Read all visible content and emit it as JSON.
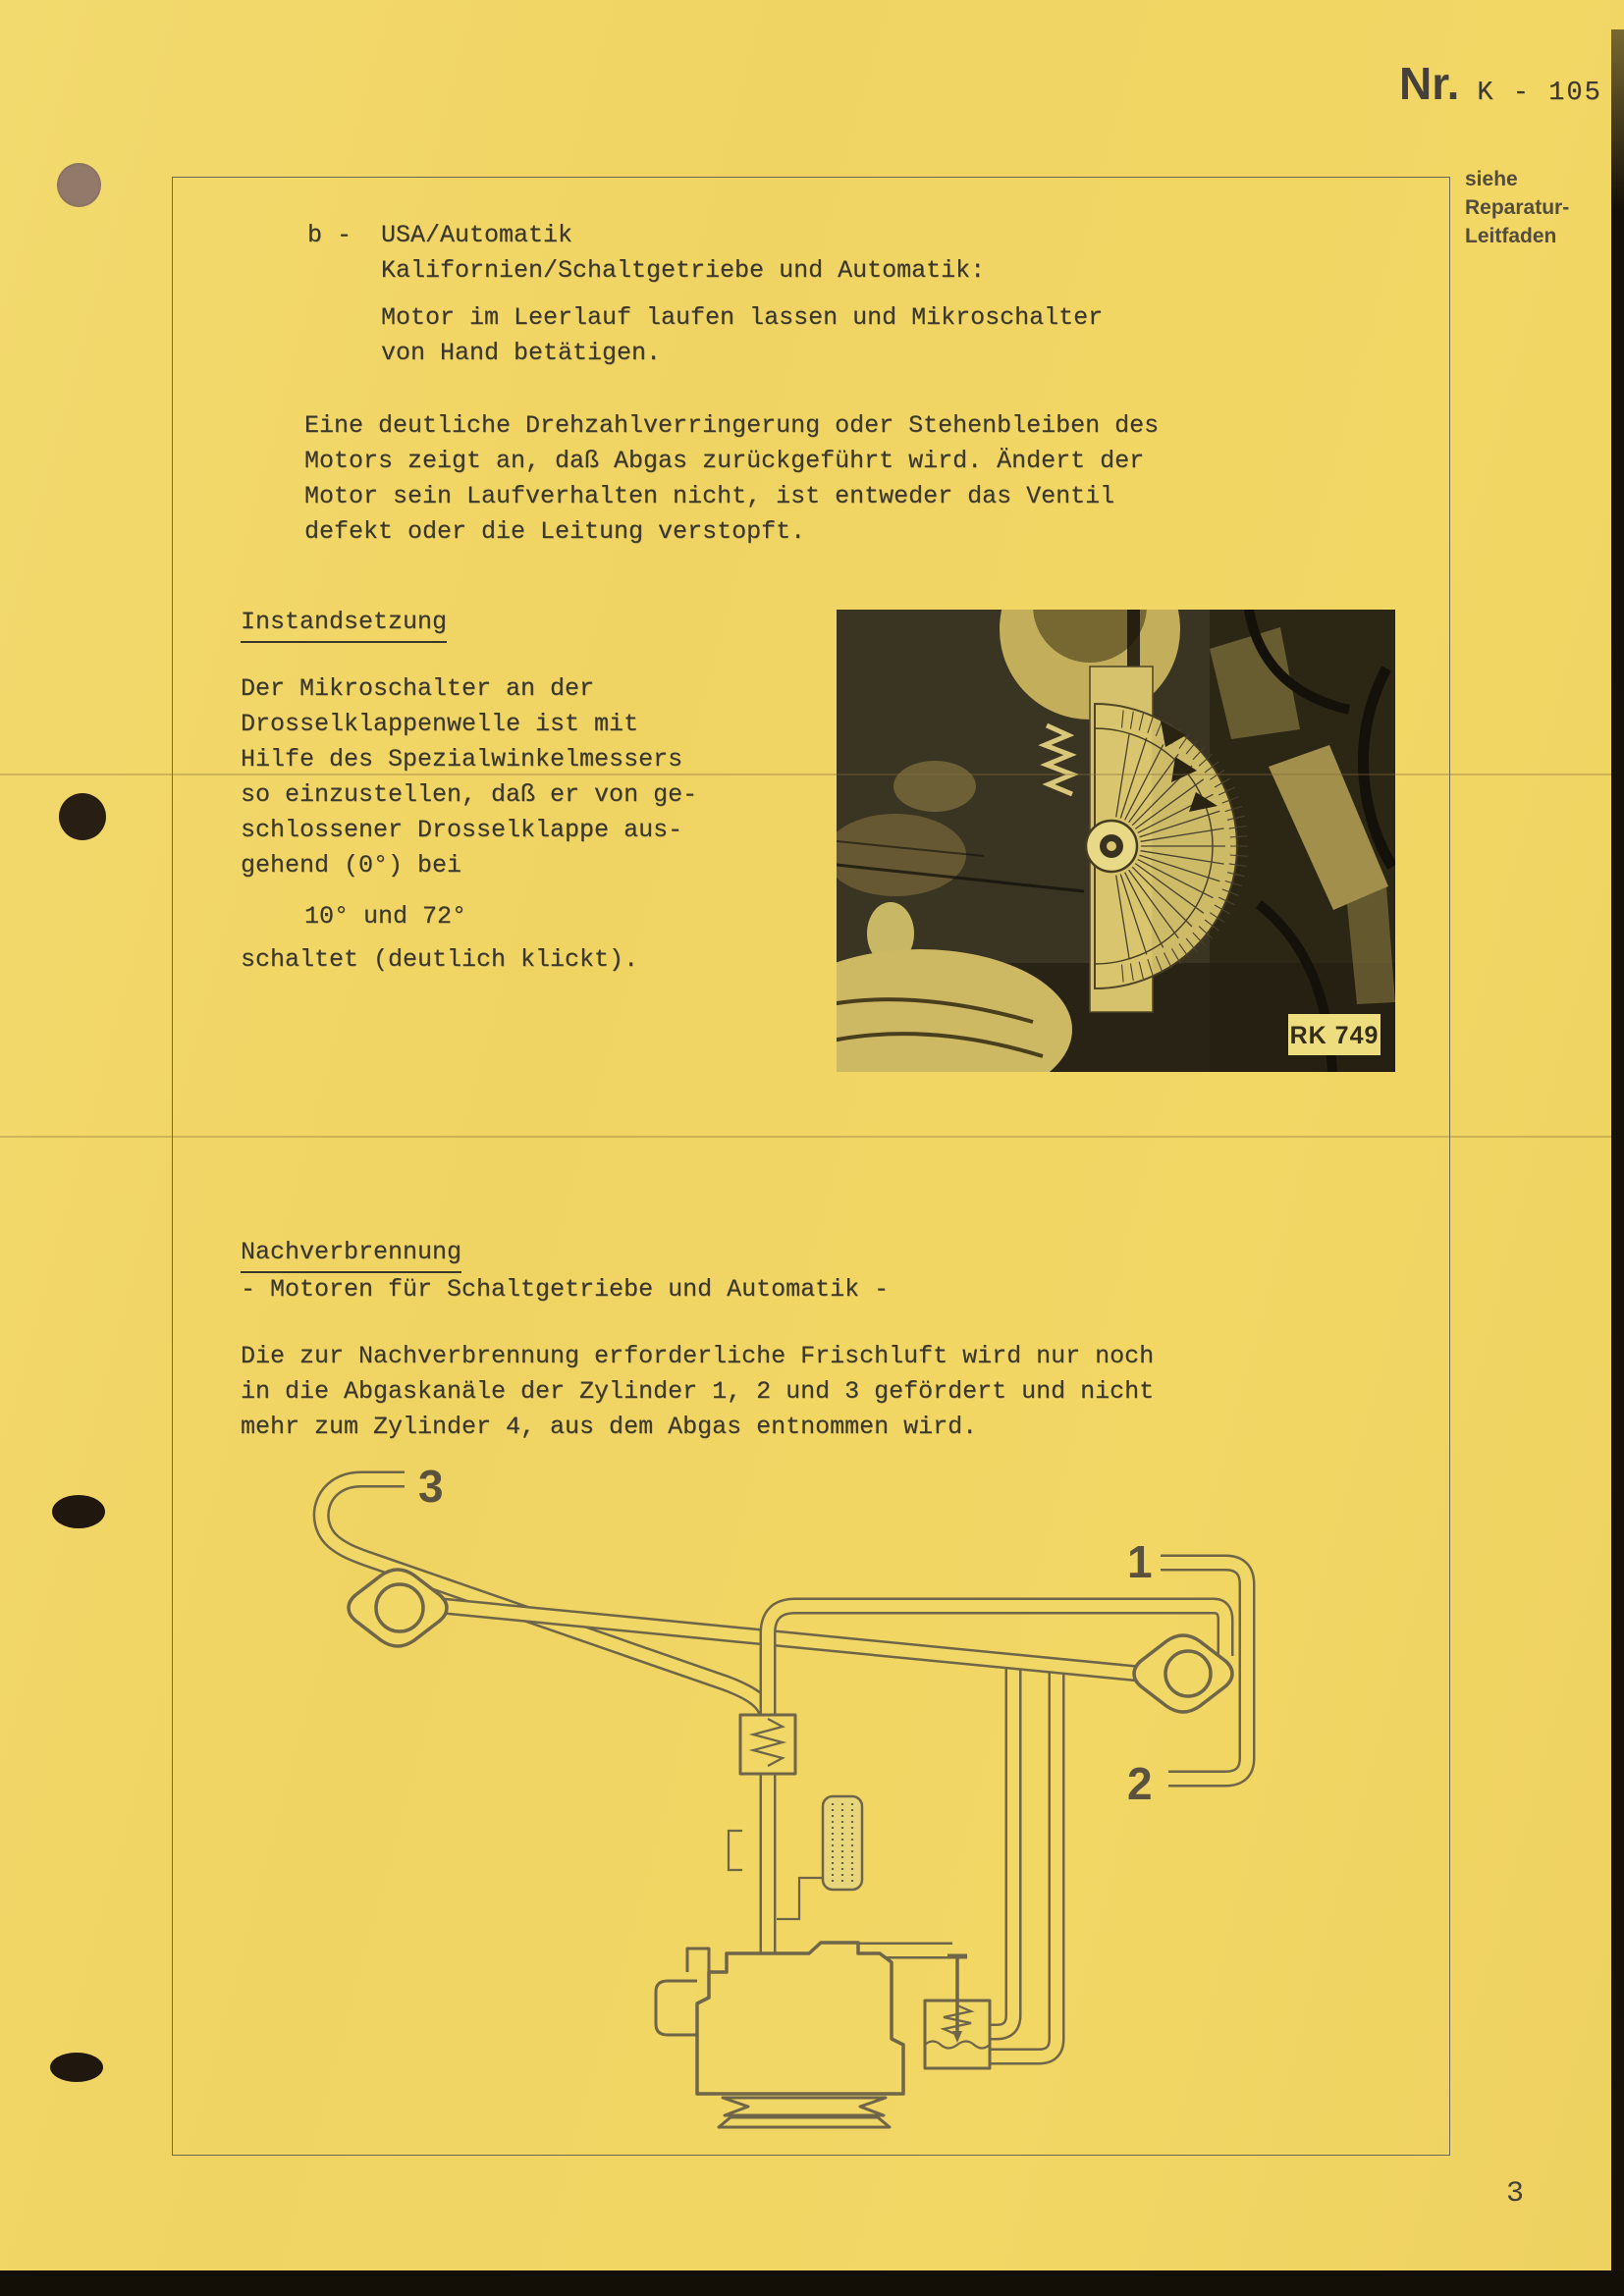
{
  "document": {
    "number_prefix": "Nr.",
    "number": "K - 105",
    "page_number": "3",
    "margin_note": [
      "siehe",
      "Reparatur-",
      "Leitfaden"
    ]
  },
  "section_b": {
    "item_label": "b -",
    "title_line1": "USA/Automatik",
    "title_line2": "Kalifornien/Schaltgetriebe und Automatik:",
    "instruction": [
      "Motor im Leerlauf laufen lassen und Mikroschalter",
      "von Hand betätigen."
    ],
    "result_paragraph": [
      "Eine deutliche Drehzahlverringerung oder Stehenbleiben des",
      "Motors zeigt an, daß Abgas zurückgeführt wird. Ändert der",
      "Motor sein Laufverhalten nicht, ist entweder das Ventil",
      "defekt oder die Leitung verstopft."
    ]
  },
  "repair_section": {
    "heading": "Instandsetzung",
    "body": [
      "Der Mikroschalter an der",
      "Drosselklappenwelle ist mit",
      "Hilfe des Spezialwinkelmessers",
      "so einzustellen, daß er von ge-",
      "schlossener Drosselklappe aus-",
      "gehend (0°) bei"
    ],
    "switch_angles": "10° und 72°",
    "closing": "schaltet (deutlich klickt).",
    "photo_label": "RK 749"
  },
  "afterburn_section": {
    "heading": "Nachverbrennung",
    "subheading": "- Motoren für Schaltgetriebe und Automatik -",
    "body": [
      "Die zur Nachverbrennung erforderliche Frischluft wird nur noch",
      "in die Abgaskanäle der Zylinder 1, 2 und 3 gefördert und nicht",
      "mehr zum Zylinder 4, aus dem Abgas entnommen wird."
    ],
    "diagram": {
      "label_1": "1",
      "label_2": "2",
      "label_3": "3"
    }
  },
  "colors": {
    "paper": "#f1d766",
    "ink": "#3b372c",
    "frame_line": "#6d6753",
    "diagram_line": "#6f6549",
    "photo_background": "#3a3422"
  }
}
